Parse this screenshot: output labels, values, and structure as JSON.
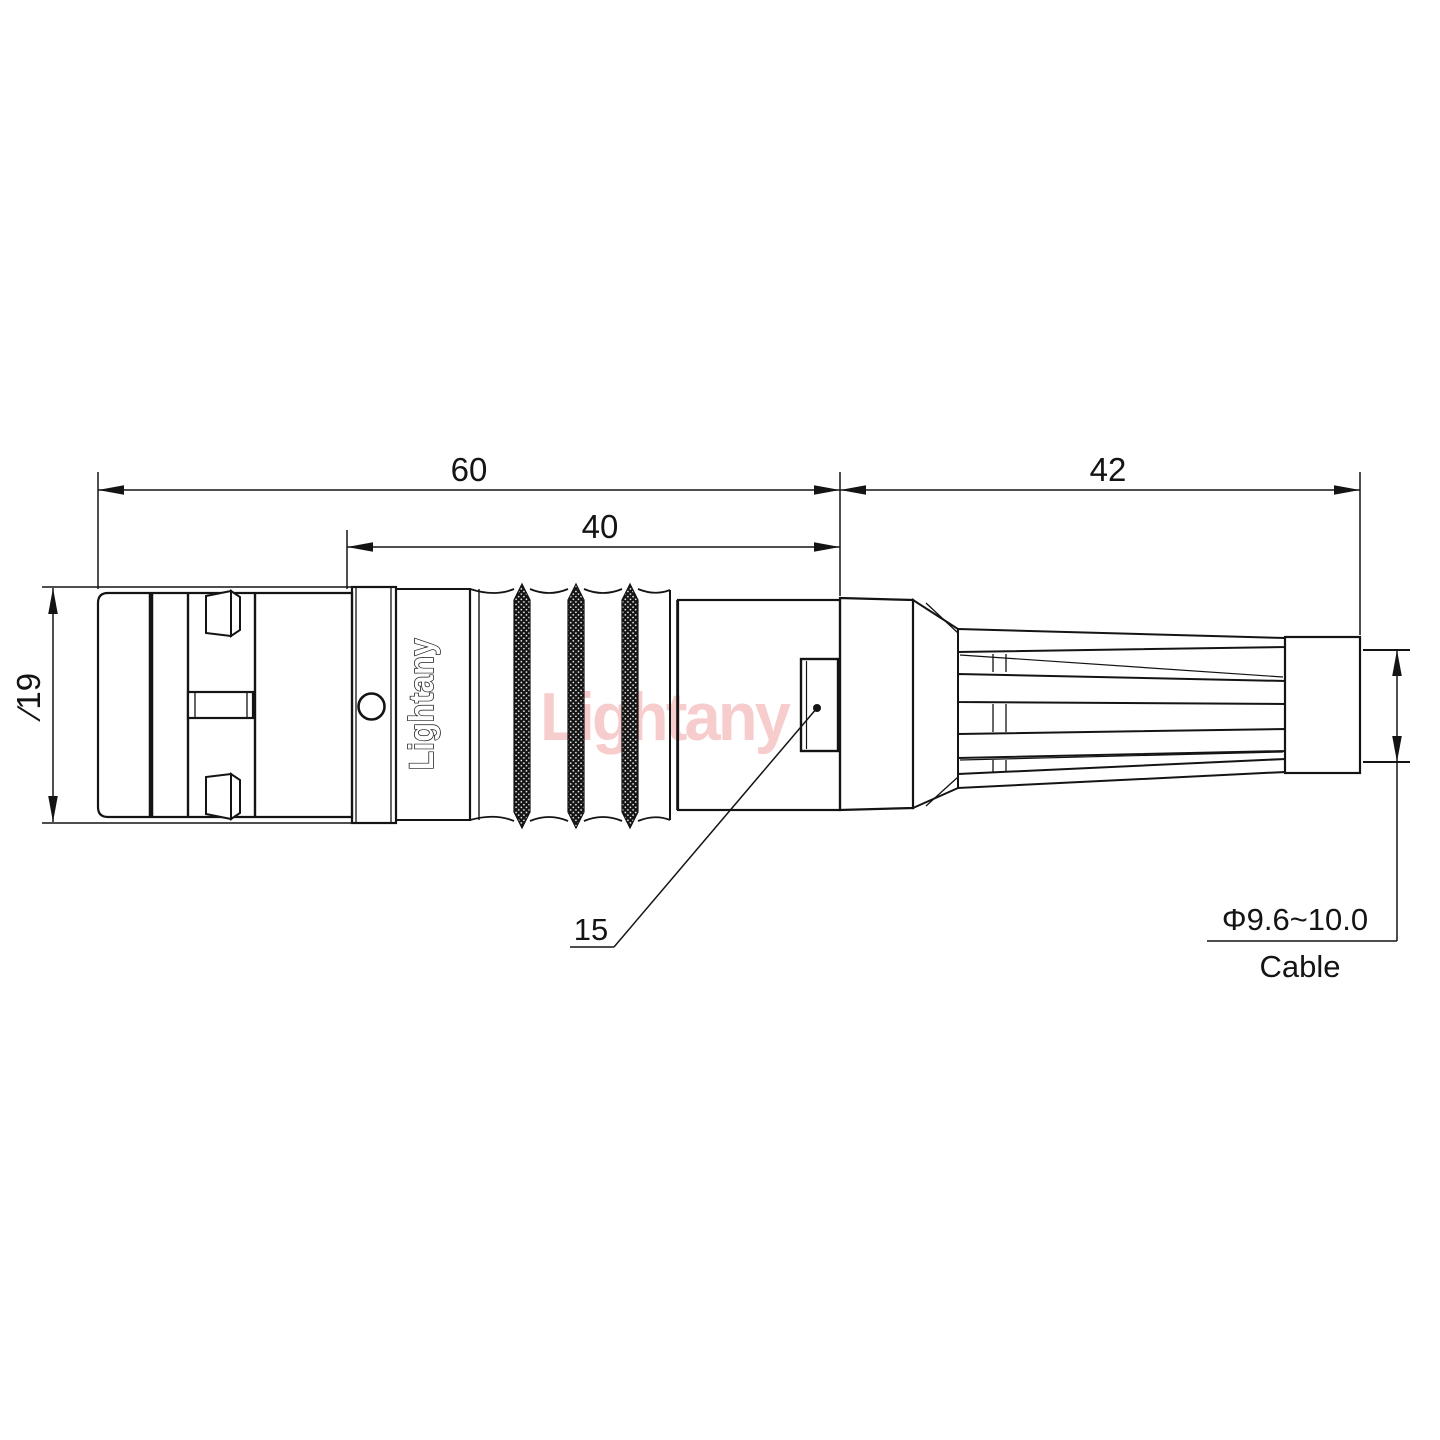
{
  "drawing": {
    "title": "connector-outline-dimension-drawing",
    "dimensions": {
      "total_length": "60",
      "mid_length": "40",
      "boot_length": "42",
      "body_diameter": "∕19",
      "nut_callout": "15",
      "cable_diameter": "Φ9.6~10.0",
      "cable_label": "Cable"
    },
    "branding": {
      "body_logo": "Lightany",
      "watermark": "Lightany"
    },
    "colors": {
      "line": "#141414",
      "watermark_pink": "#f7cccc",
      "background": "#ffffff"
    }
  }
}
